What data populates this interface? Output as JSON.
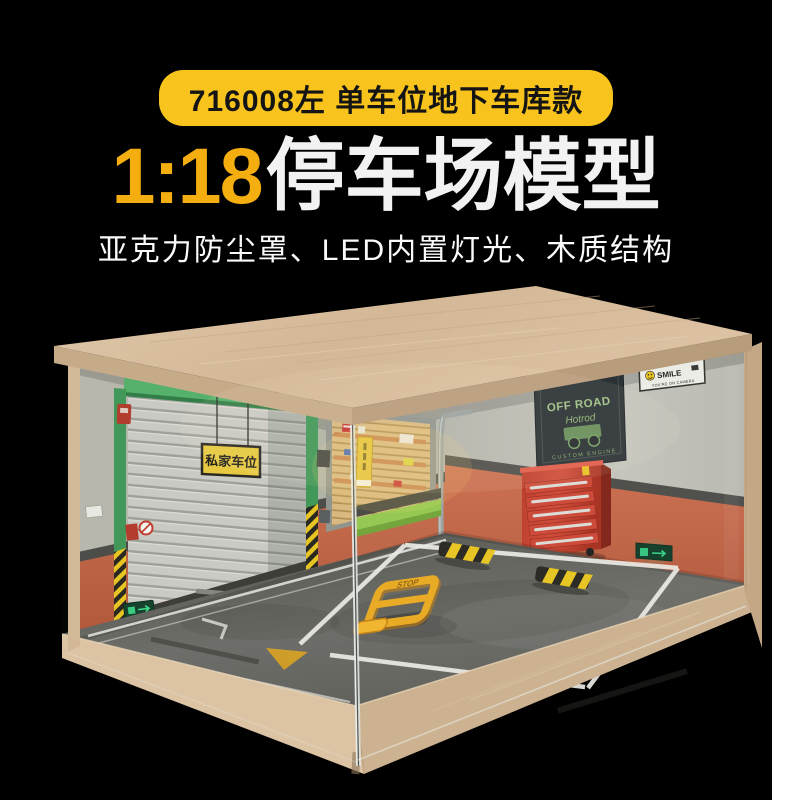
{
  "canvas": {
    "background": "#000000",
    "side_strip_color": "#ffffff"
  },
  "header": {
    "badge_label": "716008左 单车位地下车库款",
    "title_scale": "1:18",
    "title_text": "停车场模型",
    "subtitle": "亚克力防尘罩、LED内置灯光、木质结构",
    "badge_color": "#f7c31c",
    "scale_color": "#f4ae10",
    "title_color": "#f2f2f2"
  },
  "scene": {
    "door_sign_label": "私家车位",
    "offroad_banner": {
      "title": "OFF ROAD",
      "subtitle": "Hotrod",
      "footer": "CUSTOM ENGINE"
    },
    "camera_sign": {
      "title": "SMILE",
      "subtitle": "YOU'RE ON CAMERA"
    },
    "parking_lock_label": "STOP",
    "colors": {
      "wood": "#d8bf9f",
      "wall_grey": "#b4b6ac",
      "wall_orange": "#c06244",
      "floor": "#62625e",
      "door_green": "#46a35c",
      "hazard_yellow": "#e6c31e",
      "cabinet_red": "#c23f2e",
      "banner_green": "#8fb573",
      "marking_white": "#eceae4"
    }
  }
}
